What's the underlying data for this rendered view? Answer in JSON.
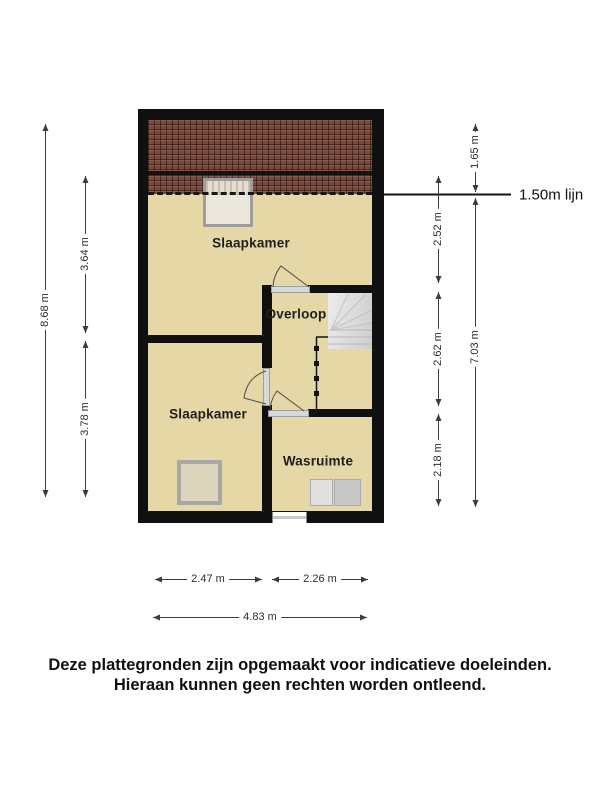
{
  "colors": {
    "floor": "#e5d8a6",
    "roof": "#7c4a3a",
    "wall": "#101010",
    "stair_light": "#ececec",
    "stair_dark": "#cdcdcd",
    "threshold": "#d8d8d8",
    "skylight_fill": "#ebe7dc",
    "skylight_border": "#9c9c9c",
    "object_fill": "#dcd6bf",
    "object_border": "#a8a8a8",
    "washer": "#e0e0e0",
    "dryer": "#c8c8c8"
  },
  "plan": {
    "rooms": [
      {
        "name": "Slaapkamer"
      },
      {
        "name": "Overloop"
      },
      {
        "name": "Slaapkamer"
      },
      {
        "name": "Wasruimte"
      }
    ],
    "objects": {
      "skylight": "roof-window",
      "square_object": "floor-object",
      "washer": "washing-machine",
      "dryer": "dryer",
      "stairs": "staircase",
      "bottom_window": "window"
    }
  },
  "dimensions": {
    "left_total": "8.68 m",
    "left_top": "3.64 m",
    "left_bottom": "3.78 m",
    "right_inner_top": "2.52 m",
    "right_inner_middle": "2.62 m",
    "right_inner_bottom": "2.18 m",
    "right_roof": "1.65 m",
    "right_total": "7.03 m",
    "attic_line_label": "1.50m lijn",
    "bottom_left": "2.47 m",
    "bottom_right": "2.26 m",
    "bottom_total": "4.83 m"
  },
  "footer": {
    "line1": "Deze plattegronden zijn opgemaakt voor indicatieve doeleinden.",
    "line2": "Hieraan kunnen geen rechten worden ontleend."
  }
}
